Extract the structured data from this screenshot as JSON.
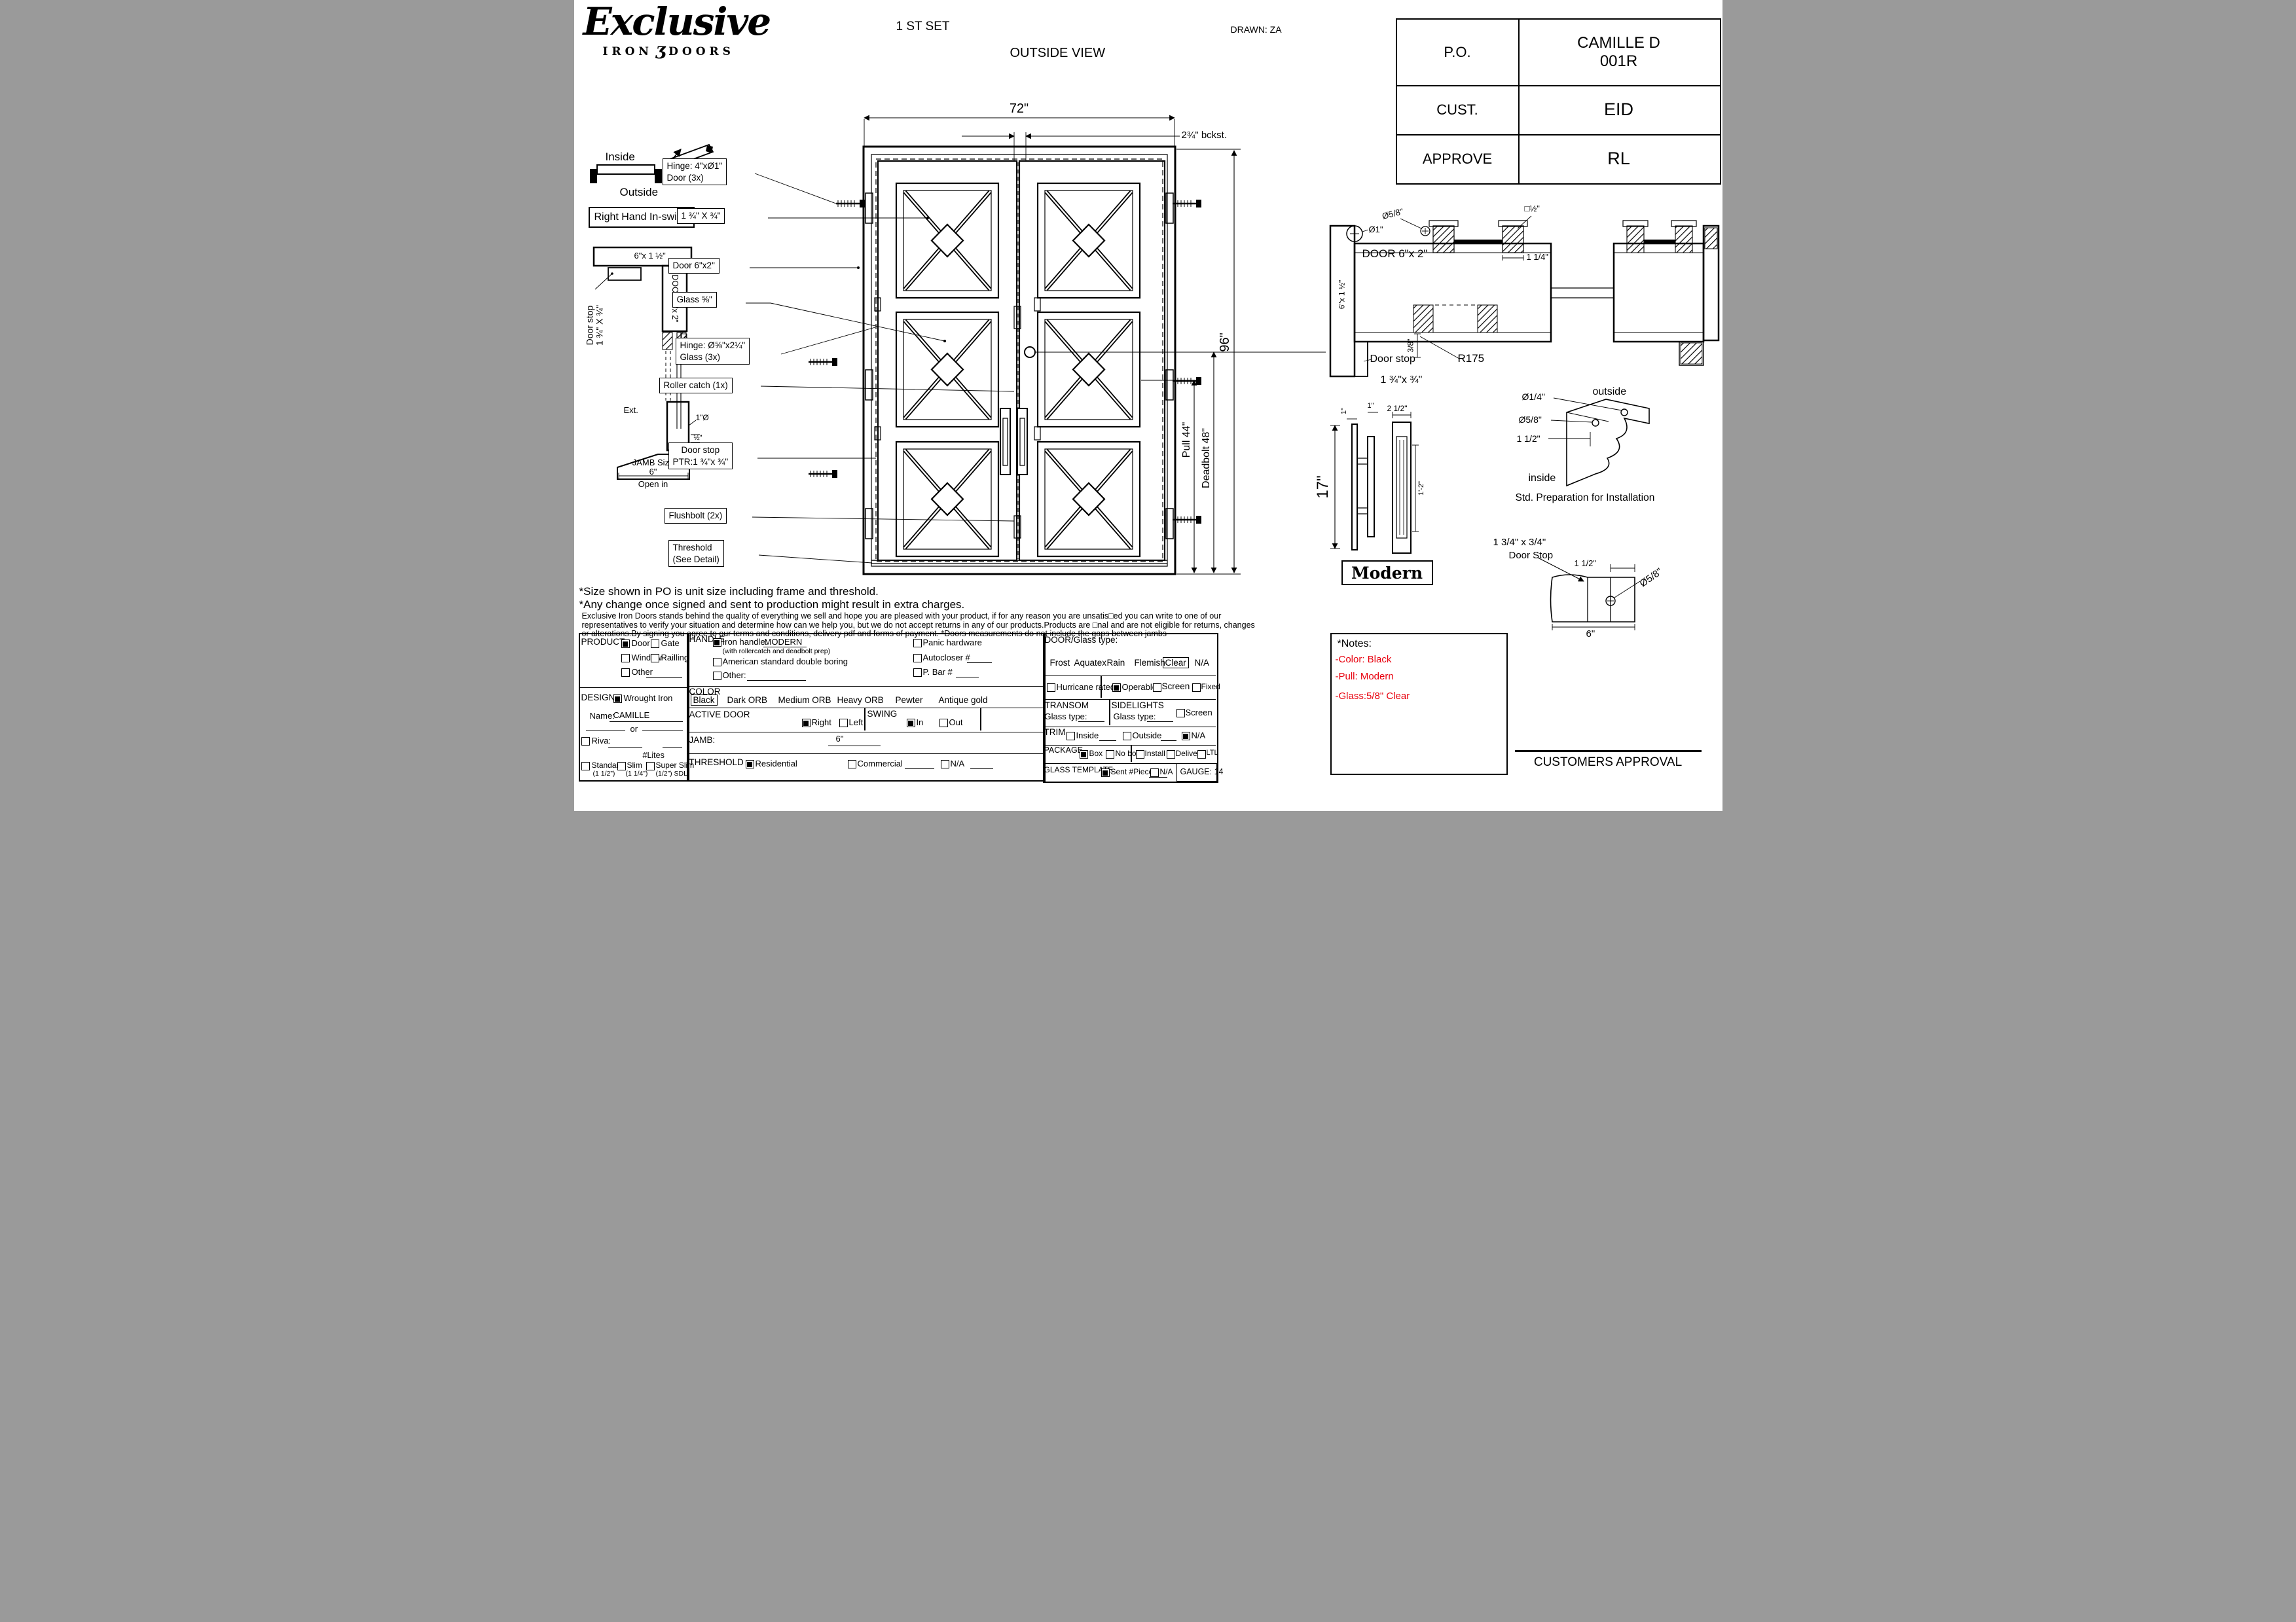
{
  "logo": {
    "script": "Exclusive",
    "iron": "IRON",
    "ornament": "ʒ",
    "doors": "DOORS"
  },
  "header": {
    "set": "1 ST SET",
    "view": "OUTSIDE VIEW",
    "drawn": "DRAWN: ZA"
  },
  "titleblock": {
    "po_label": "P.O.",
    "po_value1": "CAMILLE D",
    "po_value2": "001R",
    "cust_label": "CUST.",
    "cust_value": "EID",
    "approve_label": "APPROVE",
    "approve_value": "RL"
  },
  "swing": {
    "inside": "Inside",
    "outside": "Outside",
    "handing": "Right Hand In-swing"
  },
  "jamb_section": {
    "head": "6\"x 1 ½\"",
    "stop1": "Door stop",
    "stop2": "1 ¾\" X ¾\"",
    "door": "DOOR 6\"x 2\"",
    "half_dia": "½\"Ø",
    "ext": "Ext.",
    "one_dia": "1\"Ø",
    "half": "½\"",
    "size1": "JAMB Size",
    "size2": "6\"",
    "size3": "Open in"
  },
  "door": {
    "dim_w": "72\"",
    "dim_bckst": "2¾\" bckst.",
    "dim_h": "96\"",
    "dim_pull": "Pull 44\"",
    "dim_deadbolt": "Deadbolt 48\"",
    "callout_hinge1": "Hinge: 4\"xØ1\"",
    "callout_hinge1b": "Door (3x)",
    "callout_bar": "1 ¾\" X ¾\"",
    "callout_door": "Door 6\"x2\"",
    "callout_glass": "Glass ⅝\"",
    "callout_hinge2": "Hinge: Ø⅝\"x2¼\"",
    "callout_hinge2b": "Glass (3x)",
    "callout_roller": "Roller catch  (1x)",
    "callout_stop1": "Door stop",
    "callout_stop2": "PTR:1 ¾\"x ¾\"",
    "callout_flush": "Flushbolt (2x)",
    "callout_thresh1": "Threshold",
    "callout_thresh2": "(See Detail)"
  },
  "plan": {
    "dia1": "Ø1\"",
    "dia58": "Ø5/8\"",
    "half_sq": "□½\"",
    "door": "DOOR 6\"x 2\"",
    "dim114": "1 1/4\"",
    "dim38": "3/8\"",
    "r175": "R175",
    "jamb": "6\"x 1 ½\"",
    "stop1": "Door stop",
    "stop2": "1 ¾\"x ¾\""
  },
  "pull": {
    "h": "17\"",
    "one_a": "1\"",
    "one_b": "1\"",
    "w": "2 1/2\"",
    "inner": "1'-2\"",
    "name": "Modern"
  },
  "prep": {
    "dia14": "Ø1/4\"",
    "dia58": "Ø5/8\"",
    "dim": "1 1/2\"",
    "outside": "outside",
    "inside": "inside",
    "caption": "Std. Preparation for Installation"
  },
  "stopdetail": {
    "l1": "1 3/4\" x 3/4\"",
    "l2": "Door Stop",
    "dim112": "1 1/2\"",
    "dia58": "Ø5/8\"",
    "dim6": "6\""
  },
  "disclaimer": {
    "line1": "*Size shown in PO is unit size including frame and threshold.",
    "line2": "*Any change once signed and sent to production might result in extra charges.",
    "line3": "Exclusive Iron Doors stands behind the quality of everything we sell and hope you are pleased with your product, if for any reason you are unsatis□ed you can write to one of our",
    "line4": "representatives to verify your situation and determine how can we help you, but we do not accept returns in any of our products.Products are □nal and are not eligible for returns, changes",
    "line5": "or alterations.By signing you agree to our terms and conditions, delivery pdf and forms of payment. *Doors measurements do not include the gaps between jambs"
  },
  "form": {
    "product": {
      "title": "PRODUCT:",
      "o1": "Door",
      "o1_checked": true,
      "o2": "Gate",
      "o2_checked": false,
      "o3": "Window",
      "o3_checked": false,
      "o4": "Railling",
      "o4_checked": false,
      "o5": "Other",
      "o5_checked": false
    },
    "design": {
      "title": "DESIGN:",
      "o1": "Wrought Iron",
      "o1_checked": true,
      "name_label": "Name:",
      "name_value": "CAMILLE",
      "or": "or",
      "riva": "Riva:",
      "riva_checked": false,
      "lites": "#Lites",
      "s1": "Standard",
      "s1_sub": "(1 1/2”)",
      "s1_checked": false,
      "s2": "Slim",
      "s2_sub": "(1 1/4”)",
      "s2_checked": false,
      "s3": "Super Slim",
      "s3_sub": "(1/2”) SDL",
      "s3_checked": false
    },
    "handle": {
      "title": "HANDLE",
      "iron": "Iron handle:",
      "iron_value": "MODERN",
      "iron_checked": true,
      "iron_sub": "(with rollercatch and deadbolt prep)",
      "american": "American standard double boring",
      "american_checked": false,
      "other": "Other:",
      "other_checked": false,
      "panic": "Panic hardware",
      "panic_checked": false,
      "auto": "Autocloser #",
      "auto_checked": false,
      "pbar": "P. Bar #",
      "pbar_checked": false
    },
    "color": {
      "title": "COLOR",
      "options": [
        {
          "label": "Black",
          "boxed": true
        },
        {
          "label": "Dark ORB",
          "boxed": false
        },
        {
          "label": "Medium ORB",
          "boxed": false
        },
        {
          "label": "Heavy ORB",
          "boxed": false
        },
        {
          "label": "Pewter",
          "boxed": false
        },
        {
          "label": "Antique gold",
          "boxed": false
        }
      ]
    },
    "active": {
      "title": "ACTIVE DOOR",
      "right": "Right",
      "right_checked": true,
      "left": "Left",
      "left_checked": false
    },
    "swingbox": {
      "title": "SWING",
      "in": "In",
      "in_checked": true,
      "out": "Out",
      "out_checked": false
    },
    "jamb": {
      "title": "JAMB:",
      "value": "6\""
    },
    "threshold": {
      "title": "THRESHOLD",
      "r": "Residential",
      "r_checked": true,
      "c": "Commercial",
      "c_checked": false,
      "na": "N/A",
      "na_checked": false
    },
    "glass": {
      "title": "DOOR/Glass type:",
      "options": [
        {
          "label": "Frost",
          "boxed": false
        },
        {
          "label": "Aquatex",
          "boxed": false
        },
        {
          "label": "Rain",
          "boxed": false
        },
        {
          "label": "Flemish",
          "boxed": false
        },
        {
          "label": "Clear",
          "boxed": true
        },
        {
          "label": "N/A",
          "boxed": false
        }
      ]
    },
    "hurricane": {
      "label": "Hurricane rated",
      "checked": false,
      "operable": "Operable",
      "operable_checked": true,
      "screen": "Screen or",
      "screen_checked": false,
      "fixed": "Fixed",
      "fixed_checked": false
    },
    "transom": {
      "title": "TRANSOM",
      "glass": "Glass type:"
    },
    "sidelights": {
      "title": "SIDELIGHTS",
      "glass": "Glass type:",
      "screen": "Screen",
      "screen_checked": false
    },
    "trim": {
      "title": "TRIM",
      "inside": "Inside",
      "inside_checked": false,
      "outside": "Outside",
      "outside_checked": false,
      "na": "N/A",
      "na_checked": true
    },
    "package": {
      "title": "PACKAGE",
      "box": "Box",
      "box_checked": true,
      "nobox": "No box",
      "nobox_checked": false,
      "install": "Install",
      "install_checked": false,
      "delivery": "Delivery",
      "delivery_checked": false,
      "ltl": "LTL",
      "ltl_checked": false
    },
    "template": {
      "title": "GLASS TEMPLATE",
      "sent": "Sent #Pieces:",
      "sent_checked": true,
      "na": "N/A",
      "na_checked": false
    },
    "gauge": "GAUGE: 14"
  },
  "notes": {
    "title": "*Notes:",
    "i1": "-Color: Black",
    "i2": "-Pull: Modern",
    "i3": "-Glass:5/8\"   Clear",
    "accent_red": "#e8000d"
  },
  "approval": "CUSTOMERS APPROVAL"
}
